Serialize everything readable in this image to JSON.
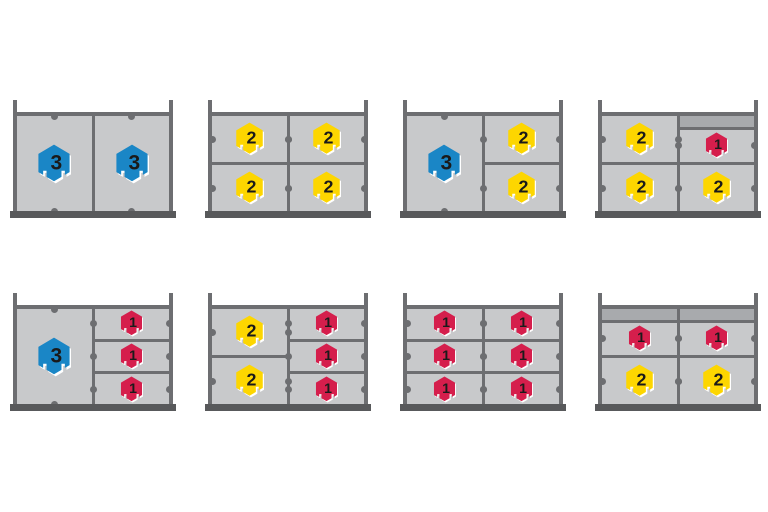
{
  "diagram": {
    "description": "Eight shelf units with compartments holding numbered hex tokens",
    "background": "#ffffff"
  },
  "palette": {
    "rail": "#6d6e71",
    "plinth": "#58595b",
    "compartment": "#c8c9cb",
    "filler_band": "#a8aaad",
    "peg": "#6d6e71",
    "token_number": "#1a1a1a",
    "token_shadow": "#ffffff"
  },
  "token_types": {
    "blue-3": {
      "label": "3",
      "color": "#1a86c6",
      "width": 34,
      "height": 40
    },
    "yellow-2": {
      "label": "2",
      "color": "#fdd600",
      "width": 29,
      "height": 34
    },
    "red-1": {
      "label": "1",
      "color": "#d51e4c",
      "width": 23,
      "height": 27
    }
  },
  "panels": [
    {
      "name": "shelf-two-tall-blue",
      "row": 0,
      "col": 0,
      "columns": [
        {
          "cells": [
            {
              "token": "blue-3"
            }
          ]
        },
        {
          "cells": [
            {
              "token": "blue-3"
            }
          ]
        }
      ]
    },
    {
      "name": "shelf-four-yellow",
      "row": 0,
      "col": 1,
      "columns": [
        {
          "cells": [
            {
              "token": "yellow-2"
            },
            {
              "token": "yellow-2"
            }
          ]
        },
        {
          "cells": [
            {
              "token": "yellow-2"
            },
            {
              "token": "yellow-2"
            }
          ]
        }
      ]
    },
    {
      "name": "shelf-blue-plus-two-yellow",
      "row": 0,
      "col": 2,
      "columns": [
        {
          "cells": [
            {
              "token": "blue-3"
            }
          ]
        },
        {
          "cells": [
            {
              "token": "yellow-2"
            },
            {
              "token": "yellow-2"
            }
          ]
        }
      ]
    },
    {
      "name": "shelf-three-yellow-one-red",
      "row": 0,
      "col": 3,
      "columns": [
        {
          "cells": [
            {
              "token": "yellow-2"
            },
            {
              "token": "yellow-2"
            }
          ]
        },
        {
          "cells": [
            {
              "token": "red-1",
              "band": true
            },
            {
              "token": "yellow-2"
            }
          ]
        }
      ]
    },
    {
      "name": "shelf-blue-plus-three-red",
      "row": 1,
      "col": 0,
      "columns": [
        {
          "cells": [
            {
              "token": "blue-3"
            }
          ]
        },
        {
          "cells": [
            {
              "token": "red-1"
            },
            {
              "token": "red-1"
            },
            {
              "token": "red-1"
            }
          ]
        }
      ]
    },
    {
      "name": "shelf-two-yellow-three-red",
      "row": 1,
      "col": 1,
      "columns": [
        {
          "cells": [
            {
              "token": "yellow-2"
            },
            {
              "token": "yellow-2"
            }
          ]
        },
        {
          "cells": [
            {
              "token": "red-1"
            },
            {
              "token": "red-1"
            },
            {
              "token": "red-1"
            }
          ]
        }
      ]
    },
    {
      "name": "shelf-six-red",
      "row": 1,
      "col": 2,
      "columns": [
        {
          "cells": [
            {
              "token": "red-1"
            },
            {
              "token": "red-1"
            },
            {
              "token": "red-1"
            }
          ]
        },
        {
          "cells": [
            {
              "token": "red-1"
            },
            {
              "token": "red-1"
            },
            {
              "token": "red-1"
            }
          ]
        }
      ]
    },
    {
      "name": "shelf-two-red-two-yellow",
      "row": 1,
      "col": 3,
      "columns": [
        {
          "cells": [
            {
              "token": "red-1",
              "band": true
            },
            {
              "token": "yellow-2"
            }
          ]
        },
        {
          "cells": [
            {
              "token": "red-1",
              "band": true
            },
            {
              "token": "yellow-2"
            }
          ]
        }
      ]
    }
  ]
}
